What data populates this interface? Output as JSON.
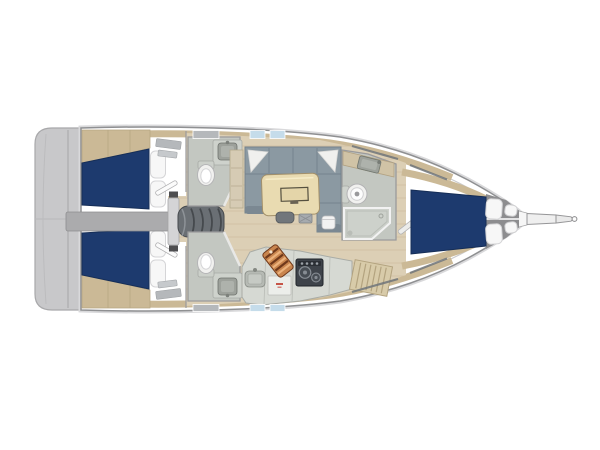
{
  "diagram": {
    "kind": "yacht-interior-floor-plan",
    "view": "top-down",
    "orientation": "bow-right-stern-left",
    "rooms": [
      "stern-swim-platform",
      "port-aft-cabin",
      "starboard-aft-cabin",
      "companionway-steps",
      "port-aft-head",
      "starboard-aft-head",
      "salon-with-u-sofa-and-table",
      "galley",
      "forward-head-with-shower",
      "forward-v-berth-cabin",
      "anchor-locker",
      "bowsprit"
    ],
    "fixtures": [
      "double-berth-mattress-navy",
      "pillows-white",
      "toilet",
      "washbasin",
      "shower-enclosure",
      "dining-table-with-folding-leaf",
      "u-shaped-sofa",
      "stool",
      "chair",
      "galley-sink",
      "two-burner-stove",
      "striped-cutting-board",
      "engine-compartment-beam",
      "deck-hatches",
      "slatted-locker"
    ]
  },
  "colors": {
    "background": "#ffffff",
    "hull_fill": "#ffffff",
    "hull_stroke": "#8f9092",
    "rub_rail": "#d9d9db",
    "inner_line": "#c9c9cb",
    "transom": "#c8c8ca",
    "deck_trim": "#cbb996",
    "floor_wood": "#dccfb5",
    "bed_navy": "#1d3a6e",
    "pillow": "#f7f7f7",
    "sofa": "#8b99a2",
    "sofa_dark": "#75838d",
    "cushion_white": "#f0f0ee",
    "table": "#e9dbb1",
    "room_floor": "#c3c7c1",
    "fixture_white": "#f1f1ef",
    "fixture_gray": "#9da19b",
    "counter": "#d6d9d3",
    "counter_beige": "#d0c3a6",
    "cabinet": "#d6cbb4",
    "stove": "#3e434a",
    "board_orange": "#c9854e",
    "steps": "#6a6f74",
    "engine_bar": "#ababad",
    "collar": "#d4d4d6",
    "locker_gray": "#8d8d8f",
    "hatch_blue": "#c5dcea",
    "vent_gray": "#b5b8bb",
    "slat": "#d8cba9",
    "red_accent": "#c0392b",
    "wall": "#9a9a9c"
  }
}
